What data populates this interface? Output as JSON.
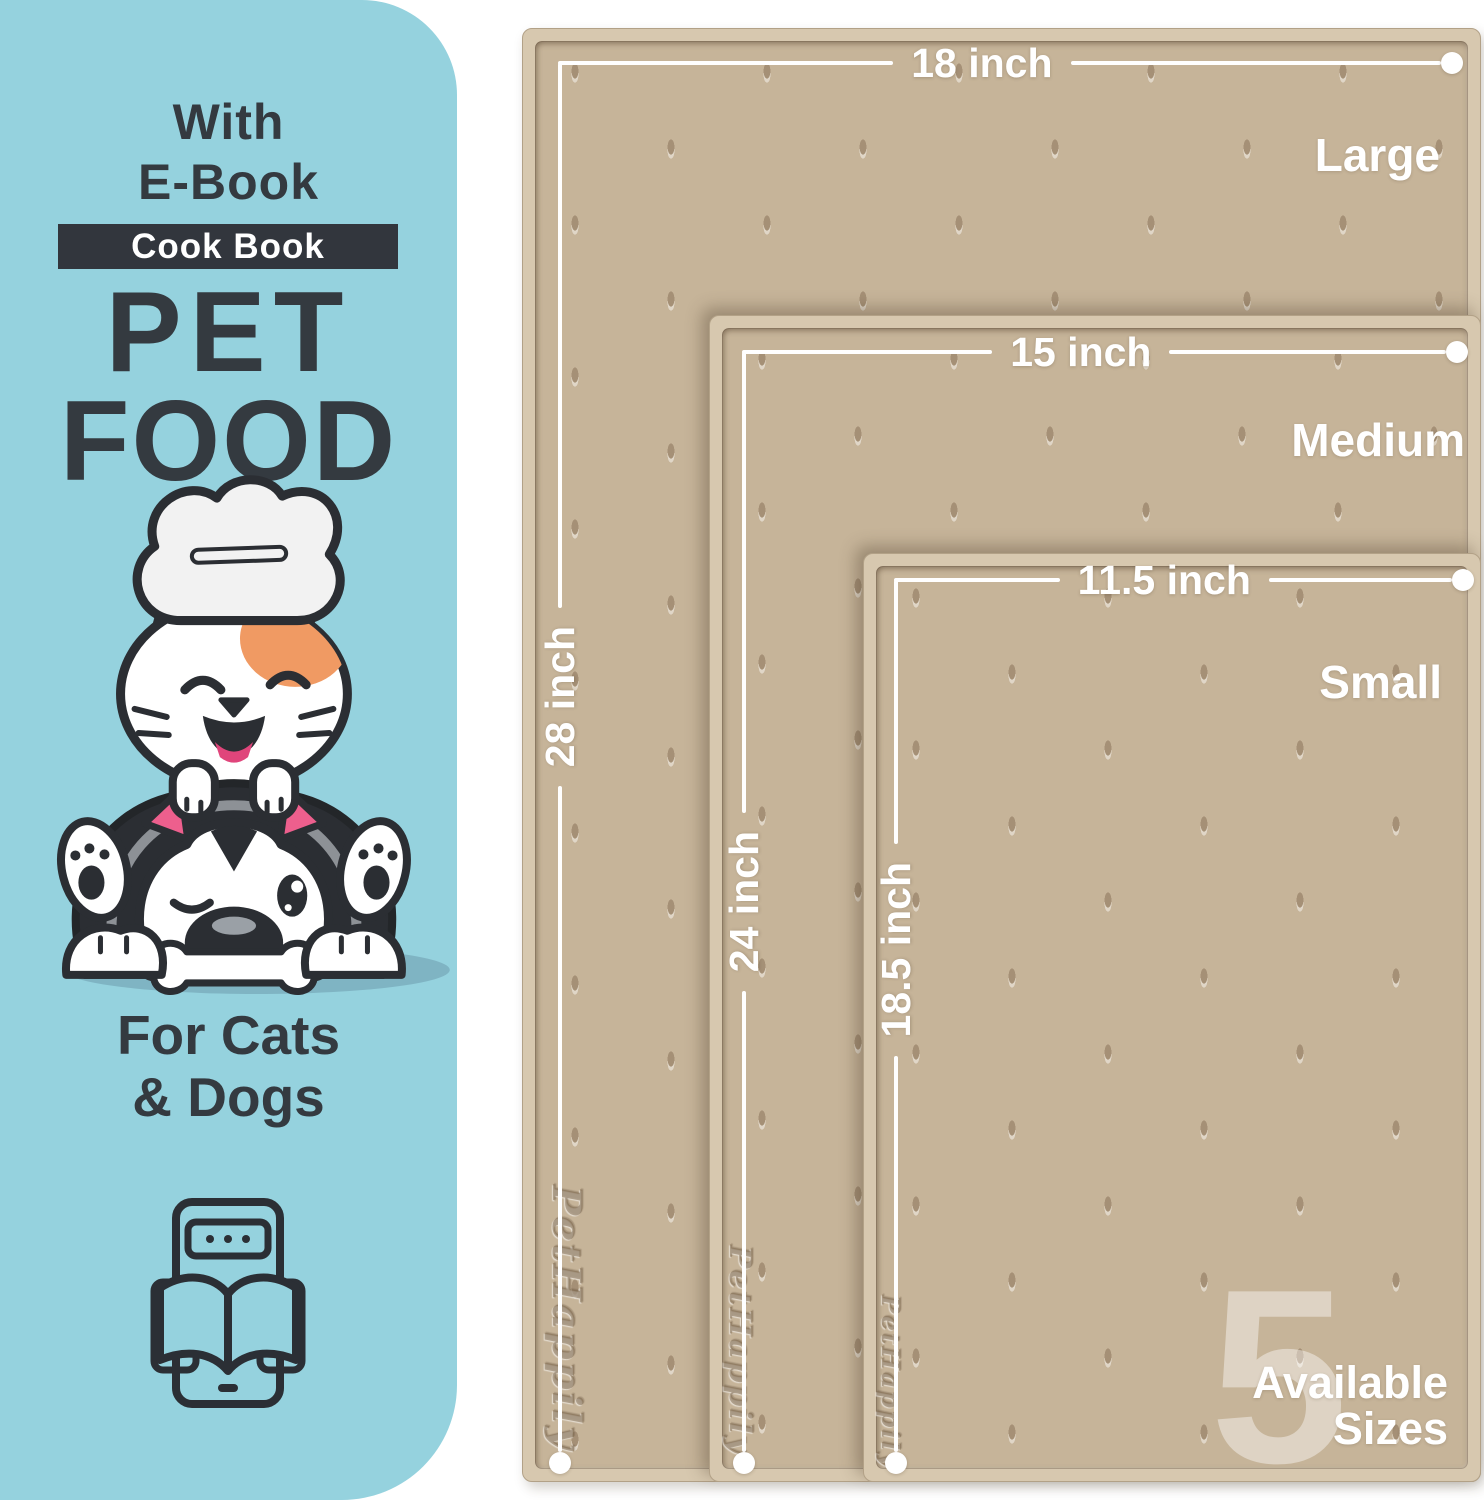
{
  "colors": {
    "panel_bg": "#95d2de",
    "ink": "#343a40",
    "badge_bg": "#32363d",
    "badge_text": "#ffffff",
    "mat_rim": "#d7c8af",
    "mat_surface": "#c6b499",
    "dimension_white": "#ffffff",
    "accent_orange": "#f09a63",
    "accent_pink": "#ed5f8d",
    "shadow_blue": "#7fb4c3"
  },
  "panel": {
    "headline_line1": "With",
    "headline_line2": "E-Book",
    "badge_label": "Cook Book",
    "title_line1": "PET",
    "title_line2": "FOOD",
    "audience_line1": "For Cats",
    "audience_line2": "& Dogs",
    "illustration": "cat-chef-on-winking-husky-with-bone",
    "footer_icon": "ebook-tablet-open-book"
  },
  "mats": [
    {
      "size_name": "Large",
      "width_label": "18 inch",
      "height_label": "28 inch",
      "emboss": "PetHappily"
    },
    {
      "size_name": "Medium",
      "width_label": "15 inch",
      "height_label": "24 inch",
      "emboss": "PetHappily"
    },
    {
      "size_name": "Small",
      "width_label": "11.5 inch",
      "height_label": "18.5 inch",
      "emboss": "PetHappily"
    }
  ],
  "availability": {
    "count": "5",
    "line1": "Available",
    "line2": "Sizes"
  }
}
